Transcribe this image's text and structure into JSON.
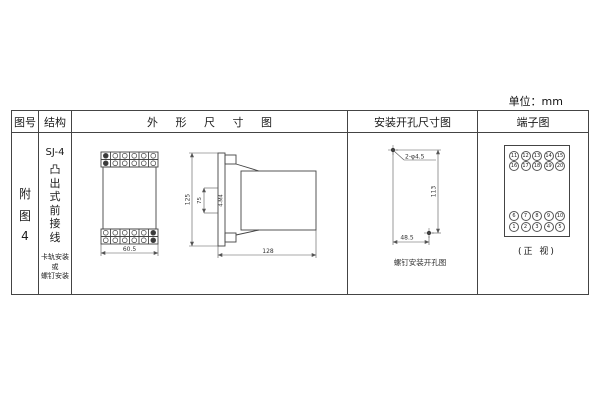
{
  "unit_label": "单位：mm",
  "headers": {
    "figure_no": "图号",
    "structure": "结构",
    "outline": "外 形 尺 寸 图",
    "mounting": "安装开孔尺寸图",
    "terminal": "端子图"
  },
  "figure_cell": {
    "line1": "附",
    "line2": "图",
    "line3": "4"
  },
  "structure_cell": {
    "model": "SJ-4",
    "type_vertical": [
      "凸",
      "出",
      "式",
      "前",
      "接",
      "线"
    ],
    "mount_note": [
      "卡轨安装",
      "或",
      "螺钉安装"
    ]
  },
  "outline_drawing": {
    "dim_width": "60.5",
    "dim_height": "125",
    "dim_inner": "75",
    "dim_screw": "4-M4",
    "dim_depth": "128"
  },
  "mounting_drawing": {
    "holes_label": "2-φ4.5",
    "dim_vertical": "113",
    "dim_horizontal": "48.5",
    "caption": "螺钉安装开孔图"
  },
  "terminal_diagram": {
    "top_group": [
      [
        "11",
        "12",
        "13",
        "14",
        "15"
      ],
      [
        "16",
        "17",
        "18",
        "19",
        "20"
      ]
    ],
    "bottom_group": [
      [
        "6",
        "7",
        "8",
        "9",
        "10"
      ],
      [
        "1",
        "2",
        "3",
        "4",
        "5"
      ]
    ],
    "caption": "(正 视)"
  }
}
